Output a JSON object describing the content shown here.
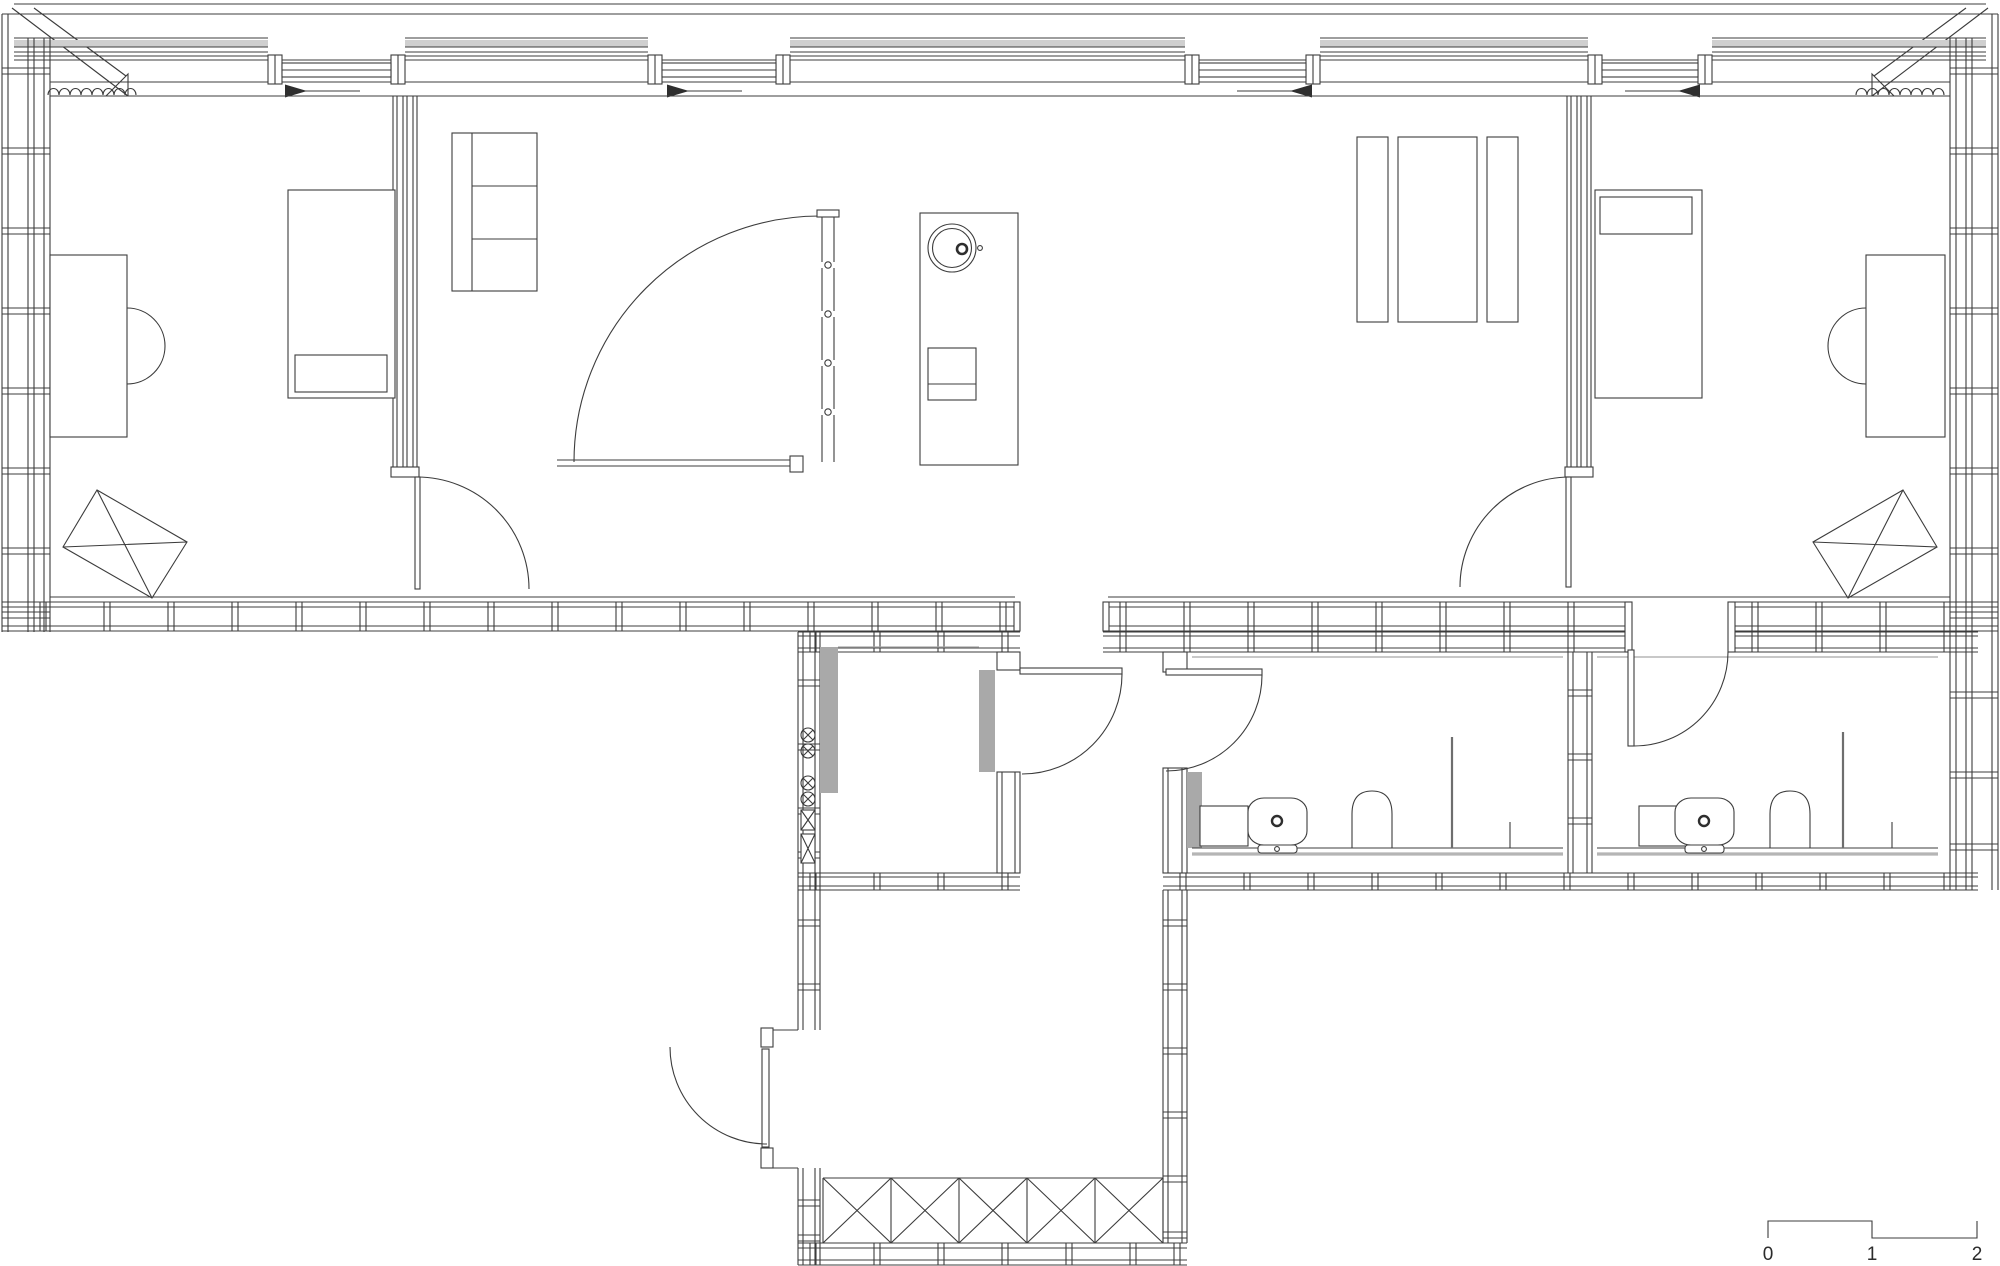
{
  "document": {
    "kind": "architectural floor plan, black line drawing on white",
    "background": "#ffffff"
  },
  "colors": {
    "line": "#3c3c3c",
    "soft_gray": "#a6a6a6",
    "wall_panel_gray": "#a9a9a9",
    "band_gray": "#cfcfcf",
    "text": "#2b2b2b"
  },
  "scale_bar": {
    "labels": [
      "0",
      "1",
      "2"
    ],
    "meter_px": 104
  },
  "windows": {
    "count": 4,
    "slide_arrows": [
      "left",
      "left",
      "right",
      "right"
    ]
  },
  "symbols": {
    "utility_circle_symbols": 4,
    "utility_box_symbols": 2,
    "entry_mat_cells": 5,
    "radiator_squiggles": 2
  },
  "fixtures": {
    "bathrooms": 2,
    "per_bathroom": [
      "cabinet",
      "washbasin",
      "toilet",
      "shower-divider"
    ],
    "kitchen_island": [
      "round-sink",
      "faucet",
      "cooktop"
    ]
  }
}
